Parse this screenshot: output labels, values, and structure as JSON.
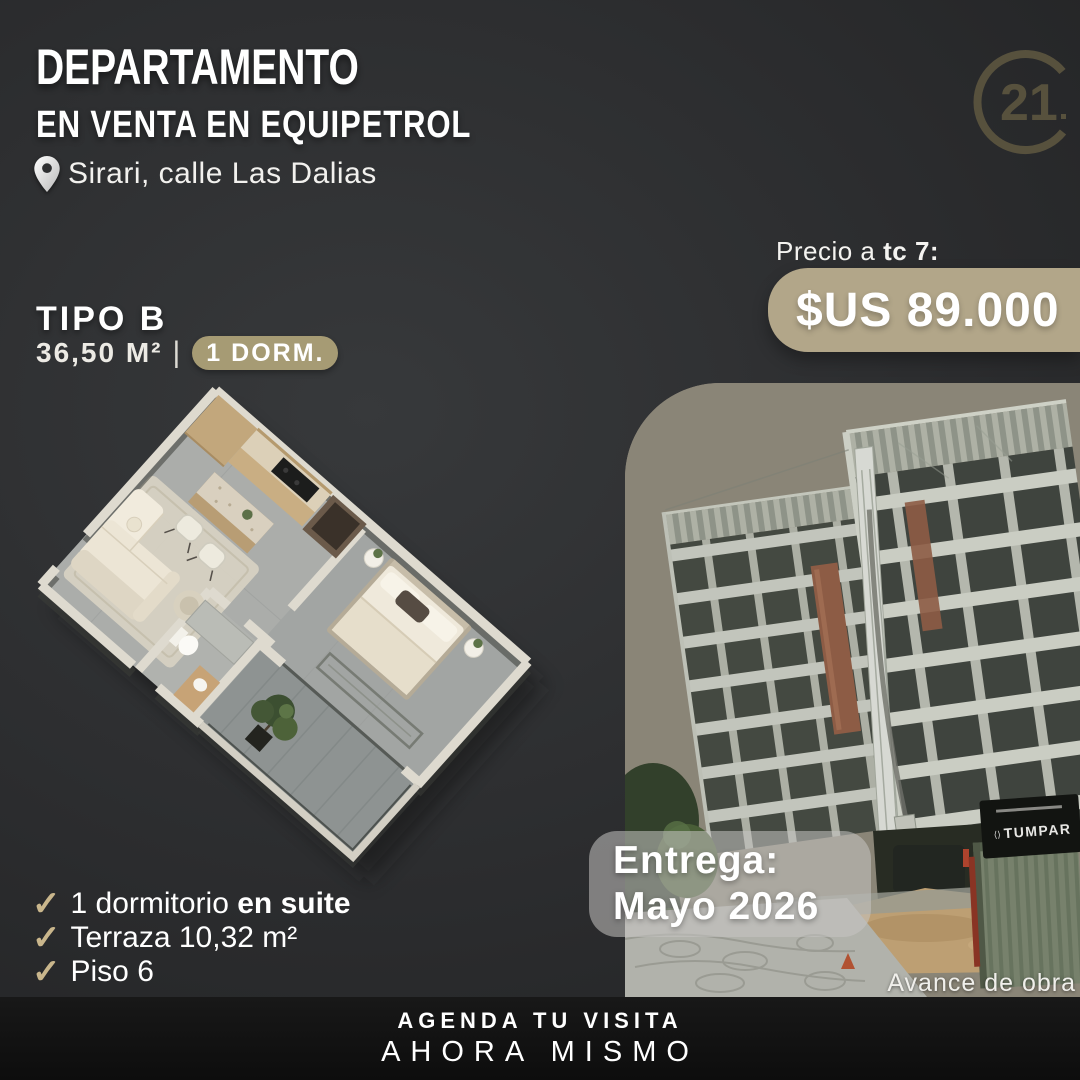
{
  "header": {
    "title": "DEPARTAMENTO",
    "subtitle": "EN VENTA EN EQUIPETROL",
    "location": "Sirari, calle Las Dalias"
  },
  "logo": {
    "brand": "Century 21",
    "number": "21",
    "color": "#57513d"
  },
  "price": {
    "label_prefix": "Precio a ",
    "label_bold": "tc 7:",
    "value": "$US 89.000",
    "box_color": "#b2a689"
  },
  "unit": {
    "type": "TIPO B",
    "area": "36,50 M²",
    "separator": "|",
    "badge": "1 DORM.",
    "badge_color": "#a69b74"
  },
  "features": [
    {
      "text": "1 dormitorio ",
      "bold": "en suite"
    },
    {
      "text": "Terraza 10,32 m²",
      "bold": ""
    },
    {
      "text": "Piso 6",
      "bold": ""
    }
  ],
  "photo": {
    "delivery_line1": "Entrega:",
    "delivery_line2": "Mayo 2026",
    "caption": "Avance de obra",
    "sign_text": "TUMPAR"
  },
  "footer": {
    "line1": "AGENDA TU VISITA",
    "line2": "AHORA MISMO"
  },
  "icons": {
    "check": "✓"
  },
  "colors": {
    "background_dark": "#2b2c2e",
    "accent_beige": "#b2a689",
    "badge_gold": "#a69b74",
    "check_gold": "#c9b68c",
    "footer_black": "#0d0d0d"
  }
}
